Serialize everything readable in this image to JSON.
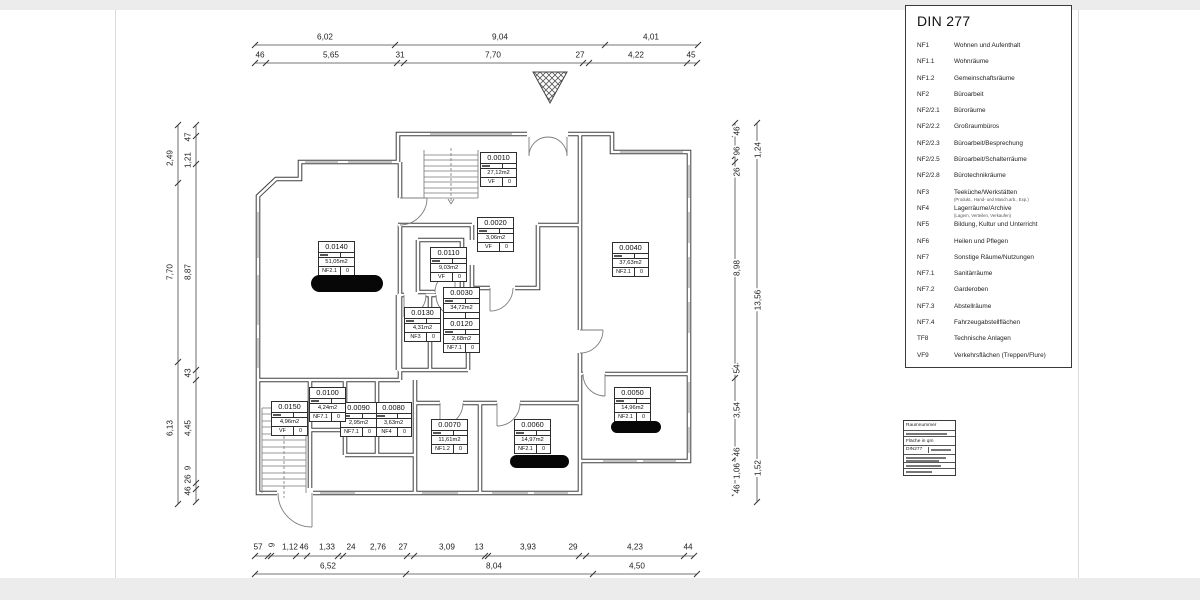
{
  "legend": {
    "title": "DIN 277",
    "items": [
      {
        "code": "NF1",
        "label": "Wohnen und Aufenthalt"
      },
      {
        "code": "NF1.1",
        "label": "Wohnräume"
      },
      {
        "code": "NF1.2",
        "label": "Gemeinschaftsräume"
      },
      {
        "code": "NF2",
        "label": "Büroarbeit"
      },
      {
        "code": "NF2/2.1",
        "label": "Büroräume"
      },
      {
        "code": "NF2/2.2",
        "label": "Großraumbüros"
      },
      {
        "code": "NF2/2.3",
        "label": "Büroarbeit/Besprechung"
      },
      {
        "code": "NF2/2.5",
        "label": "Büroarbeit/Schalterräume"
      },
      {
        "code": "NF2/2.8",
        "label": "Bürotechnikräume"
      },
      {
        "code": "NF3",
        "label": "Teeküche/Werkstätten",
        "sublabel": "(Produkt., Hand- und Masch.arb., Exp.)"
      },
      {
        "code": "NF4",
        "label": "Lagerräume/Archive",
        "sublabel": "(Lagern, Verteilen, Verkaufen)"
      },
      {
        "code": "NF5",
        "label": "Bildung, Kultur und Unterricht"
      },
      {
        "code": "NF6",
        "label": "Heilen und Pflegen"
      },
      {
        "code": "NF7",
        "label": "Sonstige Räume/Nutzungen"
      },
      {
        "code": "NF7.1",
        "label": "Sanitärräume"
      },
      {
        "code": "NF7.2",
        "label": "Garderoben"
      },
      {
        "code": "NF7.3",
        "label": "Abstellräume"
      },
      {
        "code": "NF7.4",
        "label": "Fahrzeugabstellflächen"
      },
      {
        "code": "TF8",
        "label": "Technische Anlagen"
      },
      {
        "code": "VF9",
        "label": "Verkehrsflächen (Treppen/Flure)"
      }
    ]
  },
  "stamp_key": {
    "row_number": "Raumnummer",
    "row_area": "Fläche in qm",
    "row_din": "DIN277"
  },
  "plan": {
    "entrance_marker": "crosshatched-triangle",
    "stairs": [
      "top-stair",
      "bottom-left-stair"
    ]
  },
  "rooms": [
    {
      "number": "0.0010",
      "area": "27,12m2",
      "din": "VF",
      "value": "0",
      "x": 480,
      "y": 152
    },
    {
      "number": "0.0020",
      "area": "3,06m2",
      "din": "VF",
      "value": "0",
      "x": 477,
      "y": 217
    },
    {
      "number": "0.0030",
      "area": "34,72m2",
      "din": "",
      "value": "",
      "x": 443,
      "y": 287
    },
    {
      "number": "0.0040",
      "area": "37,63m2",
      "din": "NF2.1",
      "value": "0",
      "x": 612,
      "y": 242
    },
    {
      "number": "0.0050",
      "area": "14,96m2",
      "din": "NF2.1",
      "value": "0",
      "x": 614,
      "y": 387
    },
    {
      "number": "0.0060",
      "area": "14,97m2",
      "din": "NF2.1",
      "value": "0",
      "x": 514,
      "y": 419
    },
    {
      "number": "0.0070",
      "area": "11,61m2",
      "din": "NF1.2",
      "value": "0",
      "x": 431,
      "y": 419
    },
    {
      "number": "0.0080",
      "area": "3,63m2",
      "din": "NF4",
      "value": "0",
      "x": 375,
      "y": 402
    },
    {
      "number": "0.0090",
      "area": "2,95m2",
      "din": "NF7.1",
      "value": "0",
      "x": 340,
      "y": 402
    },
    {
      "number": "0.0100",
      "area": "4,24m2",
      "din": "NF7.1",
      "value": "0",
      "x": 309,
      "y": 387
    },
    {
      "number": "0.0110",
      "area": "9,03m2",
      "din": "VF",
      "value": "0",
      "x": 430,
      "y": 247
    },
    {
      "number": "0.0120",
      "area": "2,68m2",
      "din": "NF7.1",
      "value": "0",
      "x": 443,
      "y": 318
    },
    {
      "number": "0.0130",
      "area": "4,31m2",
      "din": "NF3",
      "value": "0",
      "x": 404,
      "y": 307
    },
    {
      "number": "0.0140",
      "area": "51,05m2",
      "din": "NF2.1",
      "value": "0",
      "x": 318,
      "y": 241
    },
    {
      "number": "0.0150",
      "area": "4,96m2",
      "din": "VF",
      "value": "0",
      "x": 271,
      "y": 401
    }
  ],
  "redactions": [
    {
      "x": 311,
      "y": 275,
      "w": 72,
      "h": 17
    },
    {
      "x": 611,
      "y": 421,
      "w": 50,
      "h": 12
    },
    {
      "x": 510,
      "y": 455,
      "w": 59,
      "h": 13
    }
  ],
  "dim_labels": [
    {
      "t": "6,02",
      "x": 325,
      "y": 37
    },
    {
      "t": "9,04",
      "x": 500,
      "y": 37
    },
    {
      "t": "4,01",
      "x": 651,
      "y": 37
    },
    {
      "t": "46",
      "x": 260,
      "y": 55
    },
    {
      "t": "5,65",
      "x": 331,
      "y": 55
    },
    {
      "t": "31",
      "x": 400,
      "y": 55
    },
    {
      "t": "7,70",
      "x": 493,
      "y": 55
    },
    {
      "t": "27",
      "x": 580,
      "y": 55
    },
    {
      "t": "4,22",
      "x": 636,
      "y": 55
    },
    {
      "t": "45",
      "x": 691,
      "y": 55
    },
    {
      "t": "57",
      "x": 258,
      "y": 547
    },
    {
      "t": "9",
      "x": 272,
      "y": 545,
      "v": 1
    },
    {
      "t": "1,12",
      "x": 290,
      "y": 547
    },
    {
      "t": "46",
      "x": 304,
      "y": 547
    },
    {
      "t": "1,33",
      "x": 327,
      "y": 547
    },
    {
      "t": "24",
      "x": 351,
      "y": 547
    },
    {
      "t": "2,76",
      "x": 378,
      "y": 547
    },
    {
      "t": "27",
      "x": 403,
      "y": 547
    },
    {
      "t": "3,09",
      "x": 447,
      "y": 547
    },
    {
      "t": "13",
      "x": 479,
      "y": 547
    },
    {
      "t": "3,93",
      "x": 528,
      "y": 547
    },
    {
      "t": "29",
      "x": 573,
      "y": 547
    },
    {
      "t": "4,23",
      "x": 635,
      "y": 547
    },
    {
      "t": "44",
      "x": 688,
      "y": 547
    },
    {
      "t": "6,52",
      "x": 328,
      "y": 566
    },
    {
      "t": "8,04",
      "x": 494,
      "y": 566
    },
    {
      "t": "4,50",
      "x": 637,
      "y": 566
    },
    {
      "t": "2,49",
      "x": 170,
      "y": 158,
      "v": 1
    },
    {
      "t": "7,70",
      "x": 170,
      "y": 272,
      "v": 1
    },
    {
      "t": "6,13",
      "x": 170,
      "y": 428,
      "v": 1
    },
    {
      "t": "47",
      "x": 188,
      "y": 137,
      "v": 1
    },
    {
      "t": "1,21",
      "x": 188,
      "y": 160,
      "v": 1
    },
    {
      "t": "8,87",
      "x": 188,
      "y": 272,
      "v": 1
    },
    {
      "t": "43",
      "x": 188,
      "y": 373,
      "v": 1
    },
    {
      "t": "4,45",
      "x": 188,
      "y": 428,
      "v": 1
    },
    {
      "t": "9",
      "x": 188,
      "y": 468,
      "v": 1
    },
    {
      "t": "26",
      "x": 188,
      "y": 479,
      "v": 1
    },
    {
      "t": "46",
      "x": 188,
      "y": 491,
      "v": 1
    },
    {
      "t": "46",
      "x": 737,
      "y": 131,
      "v": 1
    },
    {
      "t": "96",
      "x": 737,
      "y": 151,
      "v": 1
    },
    {
      "t": "26",
      "x": 737,
      "y": 172,
      "v": 1
    },
    {
      "t": "8,98",
      "x": 737,
      "y": 268,
      "v": 1
    },
    {
      "t": "54",
      "x": 737,
      "y": 369,
      "v": 1
    },
    {
      "t": "3,54",
      "x": 737,
      "y": 410,
      "v": 1
    },
    {
      "t": "46",
      "x": 737,
      "y": 452,
      "v": 1
    },
    {
      "t": "1,06",
      "x": 737,
      "y": 471,
      "v": 1
    },
    {
      "t": "46",
      "x": 737,
      "y": 489,
      "v": 1
    },
    {
      "t": "1,24",
      "x": 758,
      "y": 150,
      "v": 1
    },
    {
      "t": "13,56",
      "x": 758,
      "y": 300,
      "v": 1
    },
    {
      "t": "1,52",
      "x": 758,
      "y": 468,
      "v": 1
    }
  ]
}
